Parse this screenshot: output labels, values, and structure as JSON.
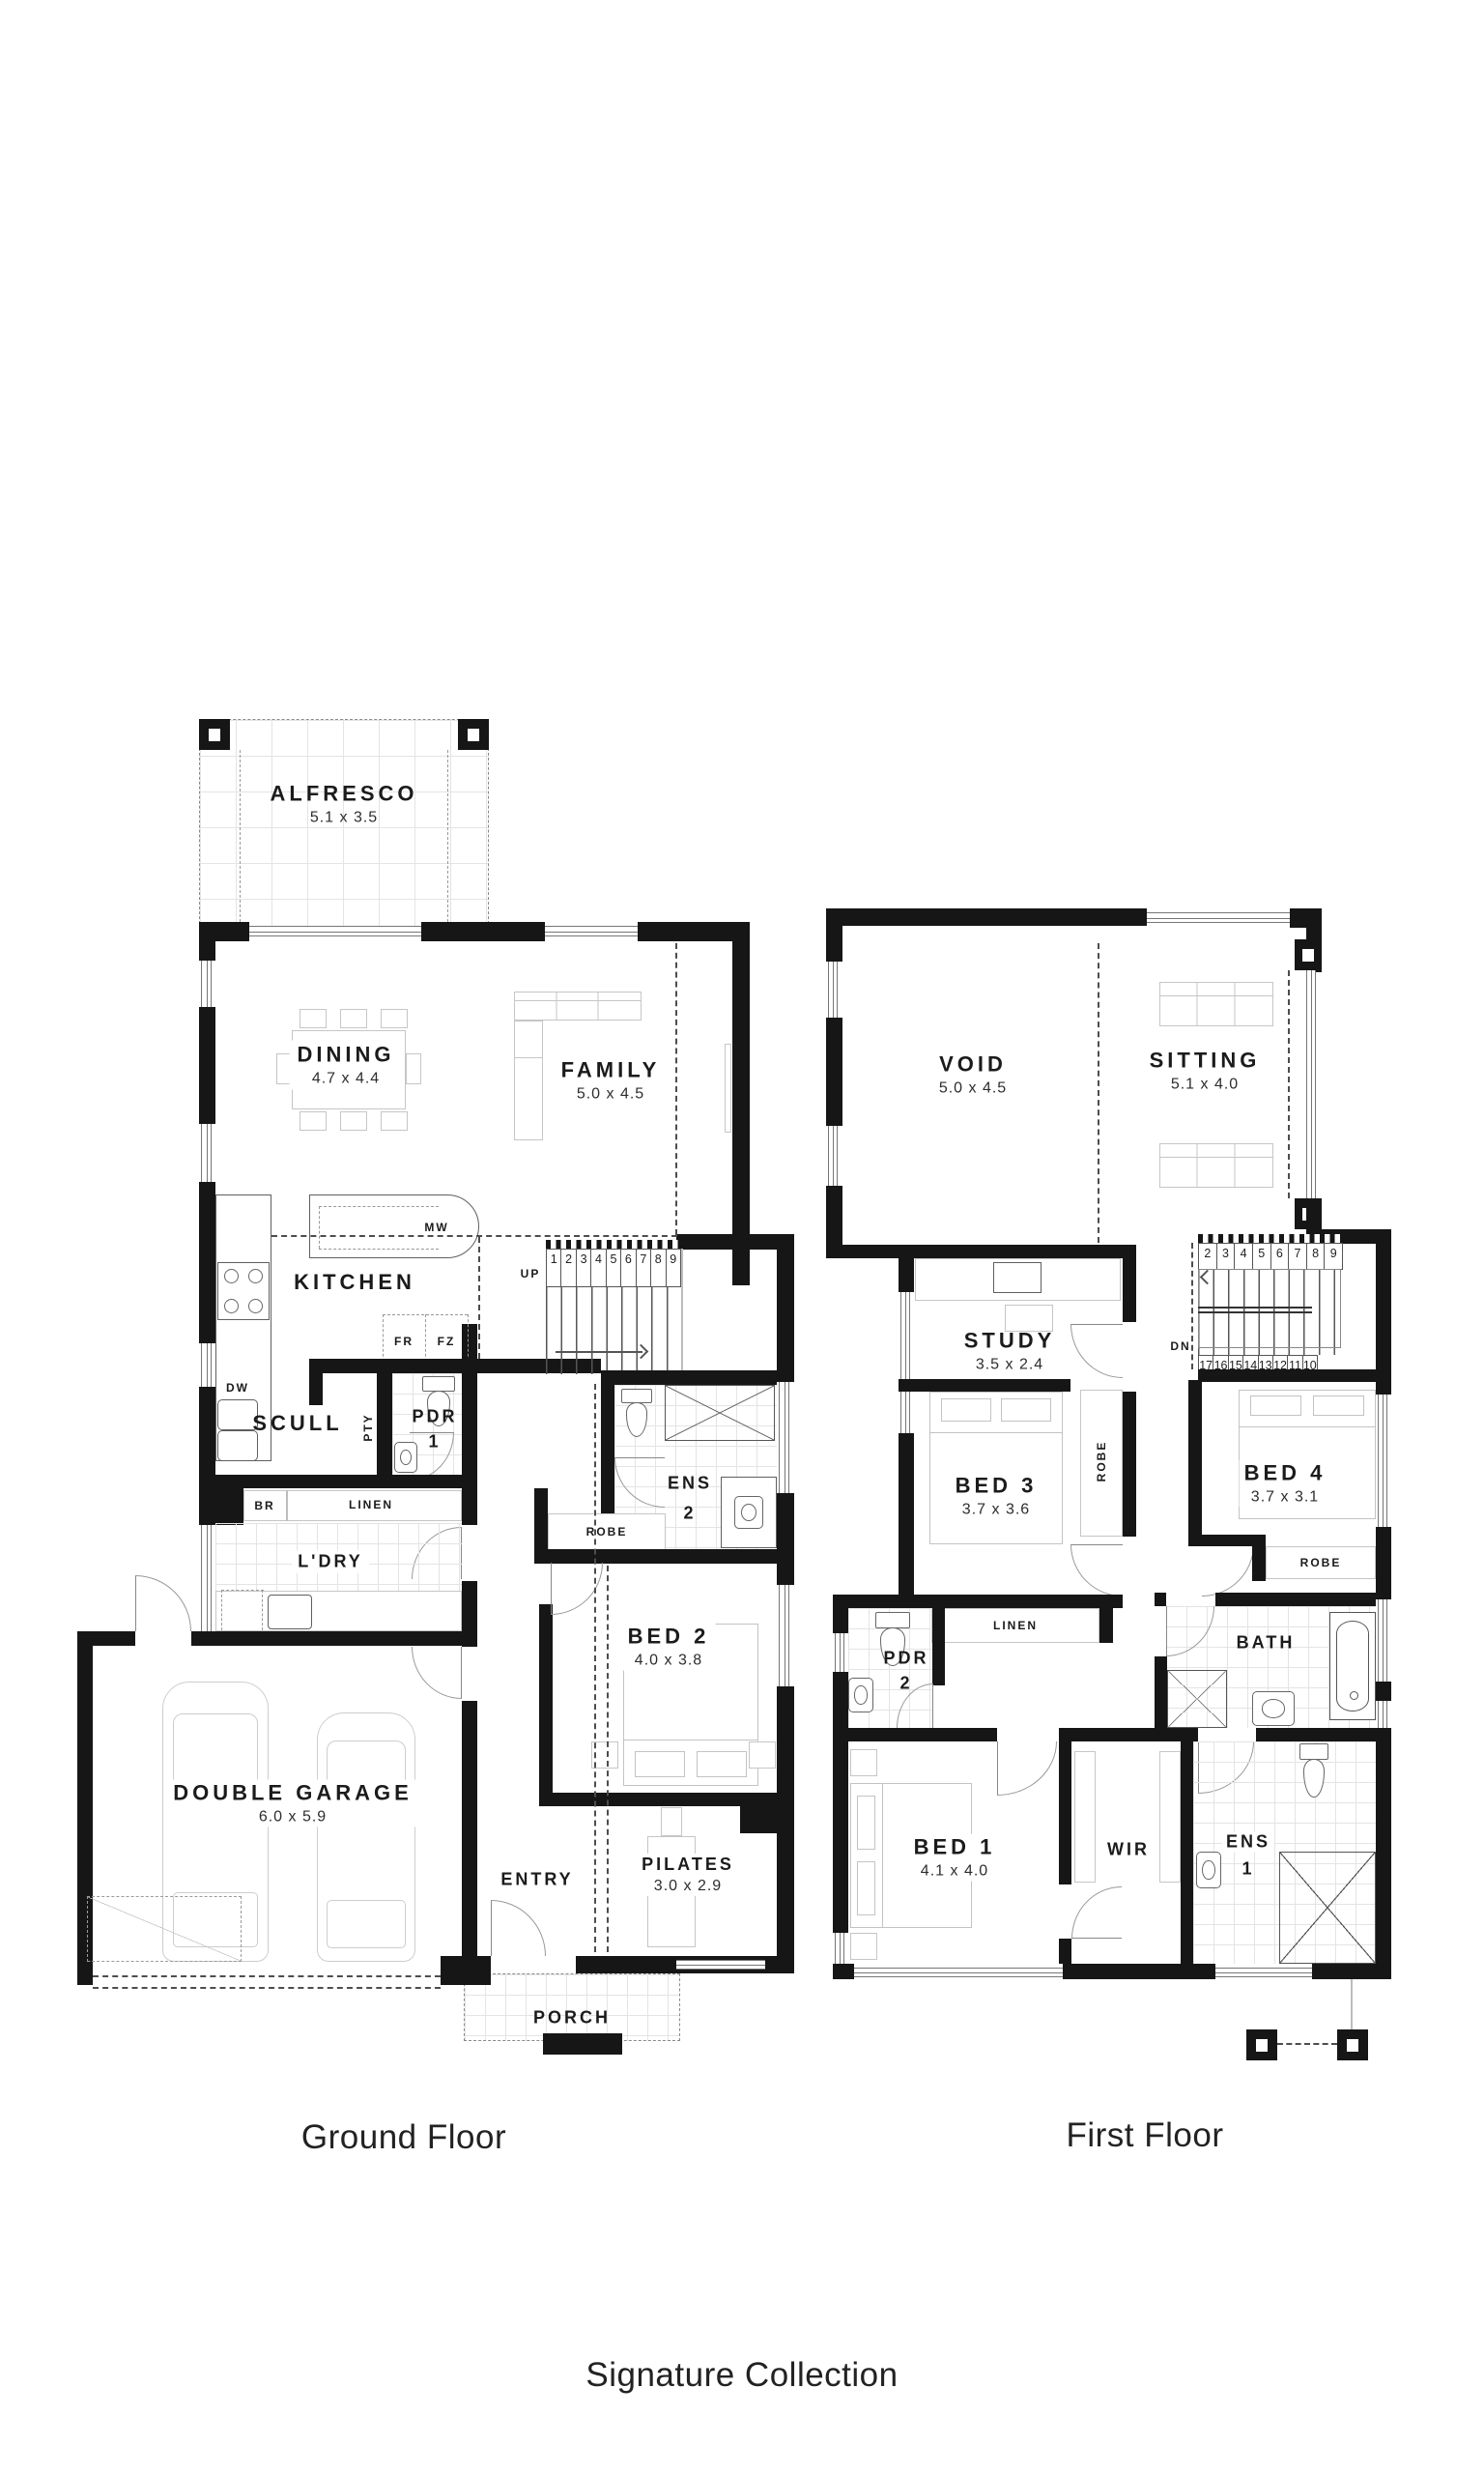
{
  "captions": {
    "ground": "Ground Floor",
    "first": "First Floor",
    "collection": "Signature Collection"
  },
  "ground": {
    "alfresco": {
      "name": "ALFRESCO",
      "dims": "5.1 x 3.5"
    },
    "dining": {
      "name": "DINING",
      "dims": "4.7 x 4.4"
    },
    "family": {
      "name": "FAMILY",
      "dims": "5.0 x 4.5"
    },
    "kitchen": {
      "name": "KITCHEN"
    },
    "scull": {
      "name": "SCULL"
    },
    "ldry": {
      "name": "L'DRY"
    },
    "bed2": {
      "name": "BED 2",
      "dims": "4.0 x 3.8"
    },
    "garage": {
      "name": "DOUBLE GARAGE",
      "dims": "6.0 x 5.9"
    },
    "entry": {
      "name": "ENTRY"
    },
    "pilates": {
      "name": "PILATES",
      "dims": "3.0 x 2.9"
    },
    "porch": {
      "name": "PORCH"
    },
    "ens2": {
      "name": "ENS",
      "num": "2"
    },
    "pdr1": {
      "name": "PDR",
      "num": "1"
    },
    "robe": {
      "name": "ROBE"
    },
    "pty": {
      "name": "PTY"
    },
    "br": {
      "name": "BR"
    },
    "linen": {
      "name": "LINEN"
    },
    "mw": {
      "name": "MW"
    },
    "dw": {
      "name": "DW"
    },
    "fr": {
      "name": "FR"
    },
    "fz": {
      "name": "FZ"
    },
    "up": {
      "name": "UP"
    },
    "stairs": [
      "1",
      "2",
      "3",
      "4",
      "5",
      "6",
      "7",
      "8",
      "9"
    ]
  },
  "first": {
    "void": {
      "name": "VOID",
      "dims": "5.0 x 4.5"
    },
    "sitting": {
      "name": "SITTING",
      "dims": "5.1 x 4.0"
    },
    "study": {
      "name": "STUDY",
      "dims": "3.5 x 2.4"
    },
    "bed3": {
      "name": "BED 3",
      "dims": "3.7 x 3.6"
    },
    "bed4": {
      "name": "BED 4",
      "dims": "3.7 x 3.1"
    },
    "bed1": {
      "name": "BED 1",
      "dims": "4.1 x 4.0"
    },
    "wir": {
      "name": "WIR"
    },
    "ens1": {
      "name": "ENS",
      "num": "1"
    },
    "pdr2": {
      "name": "PDR",
      "num": "2"
    },
    "bath": {
      "name": "BATH"
    },
    "robe3": {
      "name": "ROBE"
    },
    "robe4": {
      "name": "ROBE"
    },
    "linen": {
      "name": "LINEN"
    },
    "dn": {
      "name": "DN"
    },
    "stairs_top": [
      "2",
      "3",
      "4",
      "5",
      "6",
      "7",
      "8",
      "9"
    ],
    "stairs_bottom": [
      "17",
      "16",
      "15",
      "14",
      "13",
      "12",
      "11",
      "10"
    ]
  }
}
